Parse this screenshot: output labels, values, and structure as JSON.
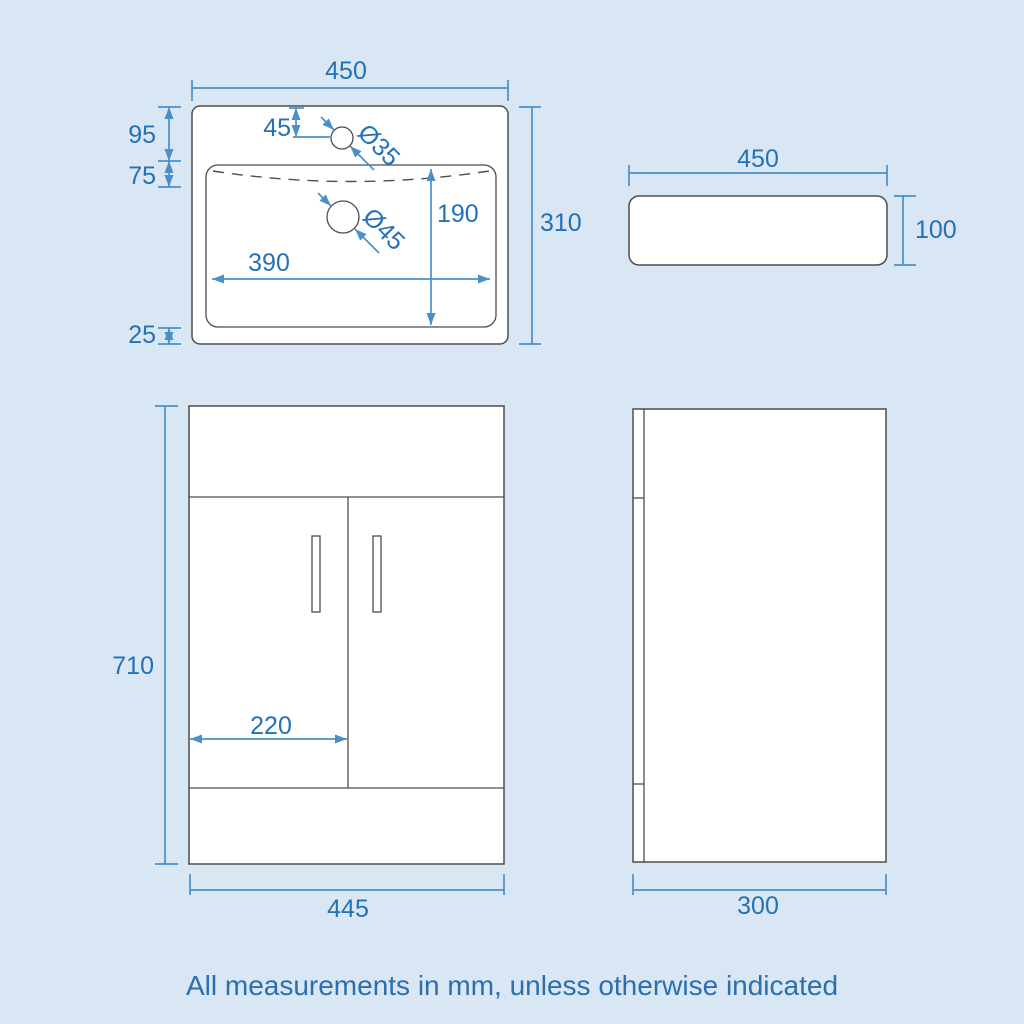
{
  "caption": "All measurements in mm, unless otherwise indicated",
  "colors": {
    "background": "#d9e6f4",
    "drawing_outline": "#4d4d4d",
    "dimension_line": "#4a90c8",
    "dimension_text": "#2471b5",
    "shape_fill": "#ffffff"
  },
  "views": {
    "basin_plan": {
      "overall_width": "450",
      "overall_depth": "310",
      "edge_to_tap": "95",
      "tap_to_bowl": "75",
      "bowl_to_edge": "25",
      "tap_offset": "45",
      "tap_hole_dia": "Ø35",
      "waste_hole_dia": "Ø45",
      "bowl_depth": "190",
      "bowl_width": "390"
    },
    "basin_side": {
      "width": "450",
      "height": "100"
    },
    "vanity_front": {
      "height": "710",
      "door_width": "220",
      "width": "445"
    },
    "vanity_side": {
      "depth": "300"
    }
  }
}
